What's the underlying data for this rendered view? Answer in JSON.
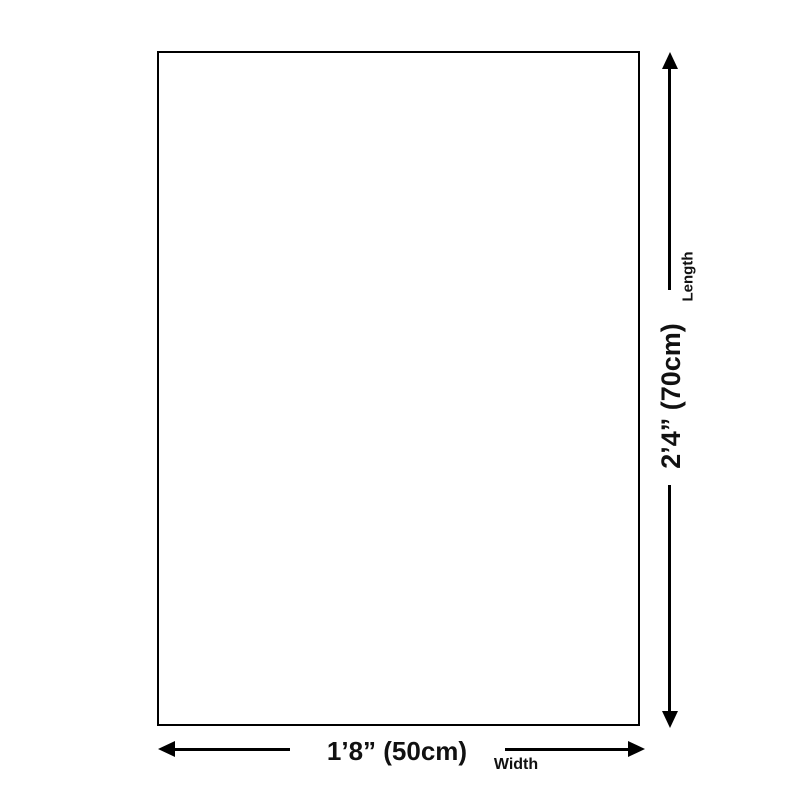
{
  "diagram": {
    "kind": "product-size-diagram",
    "canvas_fill": "#ffffff",
    "line_color": "#000000",
    "text_color": "#111111"
  },
  "dimensions": {
    "length": {
      "value": "2’4” (70cm)",
      "label": "Length"
    },
    "width": {
      "value": "1’8” (50cm)",
      "label": "Width"
    }
  }
}
